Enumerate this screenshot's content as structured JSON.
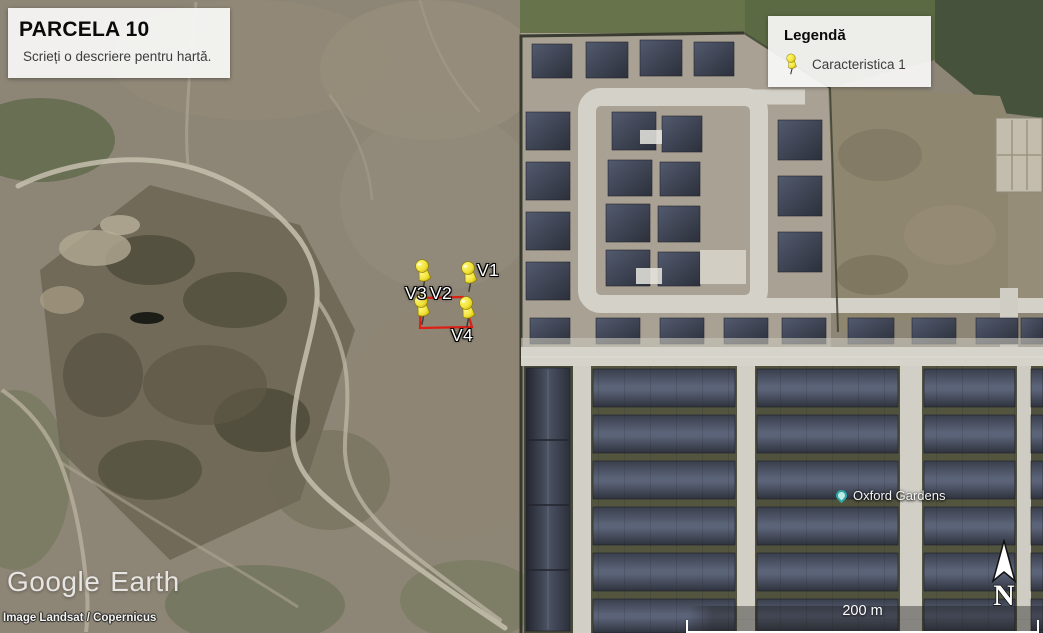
{
  "title_box": {
    "title": "PARCELA 10",
    "description": "Scrieți o descriere pentru hartă."
  },
  "legend": {
    "title": "Legendă",
    "items": [
      {
        "icon": "pushpin-icon",
        "label": "Caracteristica 1"
      }
    ]
  },
  "placemarks": {
    "pins": [
      {
        "label": "V1"
      },
      {
        "label": "V2"
      },
      {
        "label": "V3"
      },
      {
        "label": "V4"
      }
    ],
    "pin_color": "#f2e339",
    "polygon_color": "#dd1f14"
  },
  "map_labels": {
    "place": "Oxford Gardens",
    "place_marker_color": "#2ba8a4"
  },
  "scale_bar": {
    "label": "200 m"
  },
  "compass": {
    "north_label": "N"
  },
  "branding": {
    "logo_primary": "Google",
    "logo_secondary": "Earth",
    "attribution": "Image Landsat / Copernicus"
  }
}
